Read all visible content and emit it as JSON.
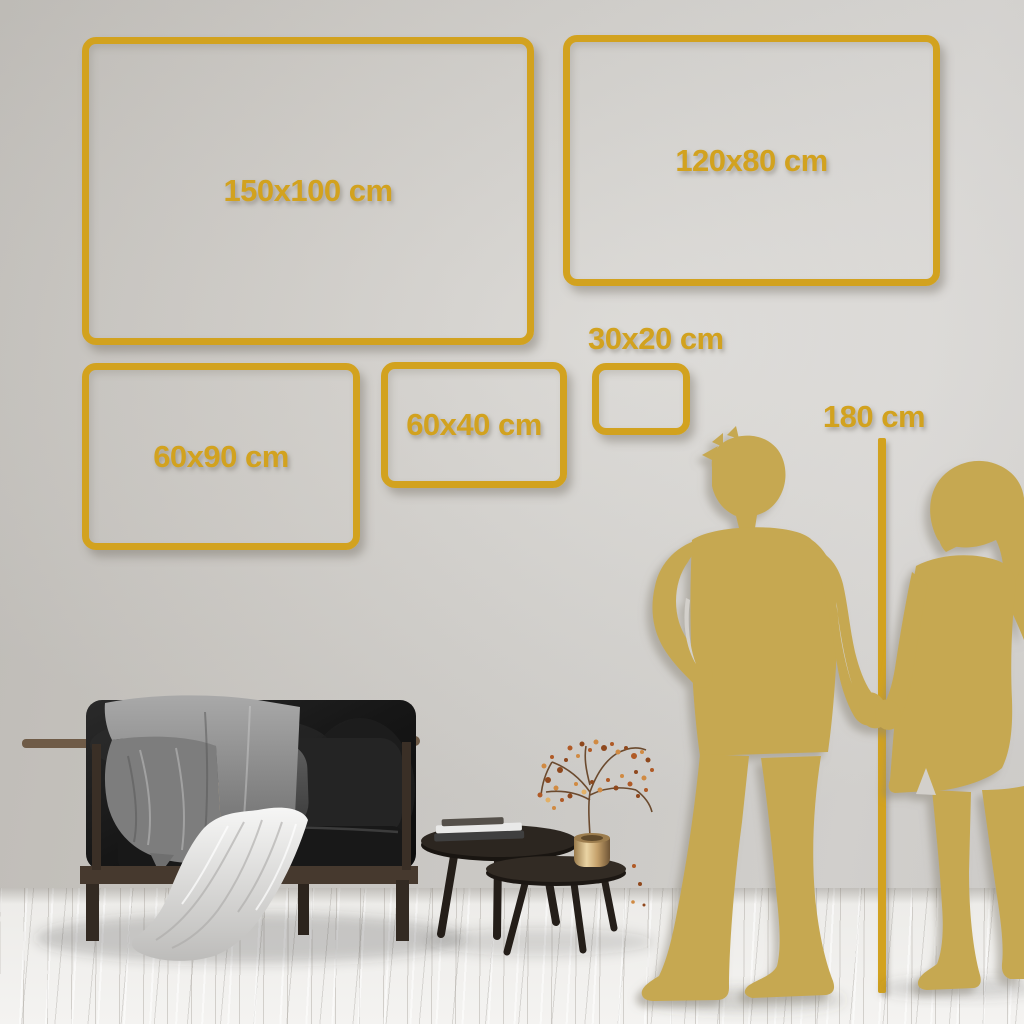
{
  "size_frames": [
    {
      "label": "150x100 cm"
    },
    {
      "label": "120x80 cm"
    },
    {
      "label": "60x90 cm"
    },
    {
      "label": "60x40 cm"
    },
    {
      "label": "30x20 cm"
    }
  ],
  "height_reference": {
    "label": "180 cm"
  },
  "palette": {
    "accent_gold": "#D2A21F",
    "silhouette_gold": "#C6A851",
    "wall_gray": "#D3D0CB",
    "floor_white": "#F0EFEC"
  },
  "decor": {
    "couple": "couple-holding-hands-silhouette",
    "sofa": "dark-sofa-with-throw-blanket",
    "tables": "nesting-coffee-tables",
    "books": "stacked-books",
    "vase": "brass-vase-with-dried-flowers"
  }
}
